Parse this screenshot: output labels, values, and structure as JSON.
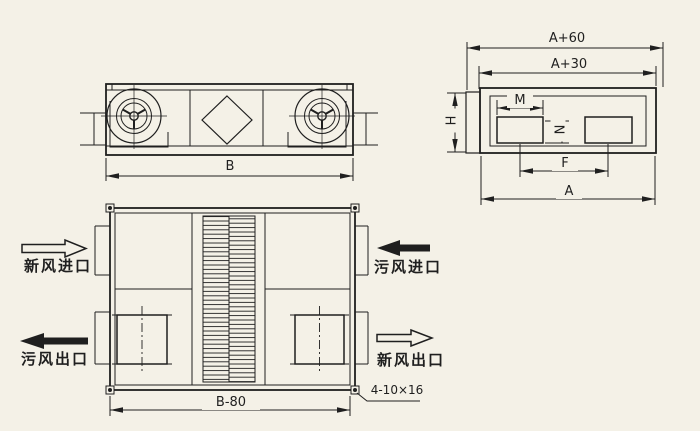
{
  "drawing_type": "air-handling-unit-outline-drawing",
  "dimensions": {
    "front_width": "B",
    "overall_width_outer": "A+60",
    "overall_width_inner": "A+30",
    "height": "H",
    "opening_width": "M",
    "opening_height": "N",
    "opening_span": "F",
    "depth": "A",
    "base_width": "B-80",
    "mounting_note": "4-10×16"
  },
  "ports": {
    "fresh_air_inlet": "新风进口",
    "exhaust_air_outlet": "污风出口",
    "exhaust_air_inlet": "污风进口",
    "fresh_air_outlet": "新风出口"
  },
  "colors": {
    "paper": "#f4f1e7",
    "ink": "#1f1f1f"
  }
}
